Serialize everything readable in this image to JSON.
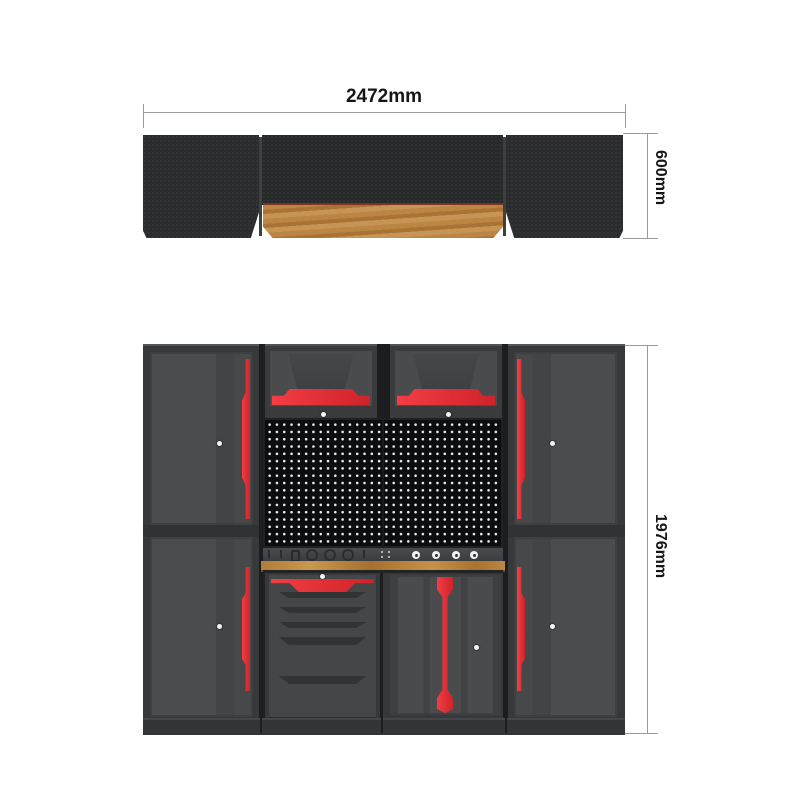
{
  "dimensions": {
    "width_label": "2472mm",
    "depth_label": "600mm",
    "height_label": "1976mm"
  },
  "colors": {
    "background": "#ffffff",
    "accent_red": "#e8363c",
    "cabinet_frame": "#3a3b3d",
    "door_face": "#48494b",
    "pegboard_black": "#0c0d0e",
    "wood": "#b5803d",
    "dimension_line": "#9b9b9b",
    "text": "#161616"
  }
}
